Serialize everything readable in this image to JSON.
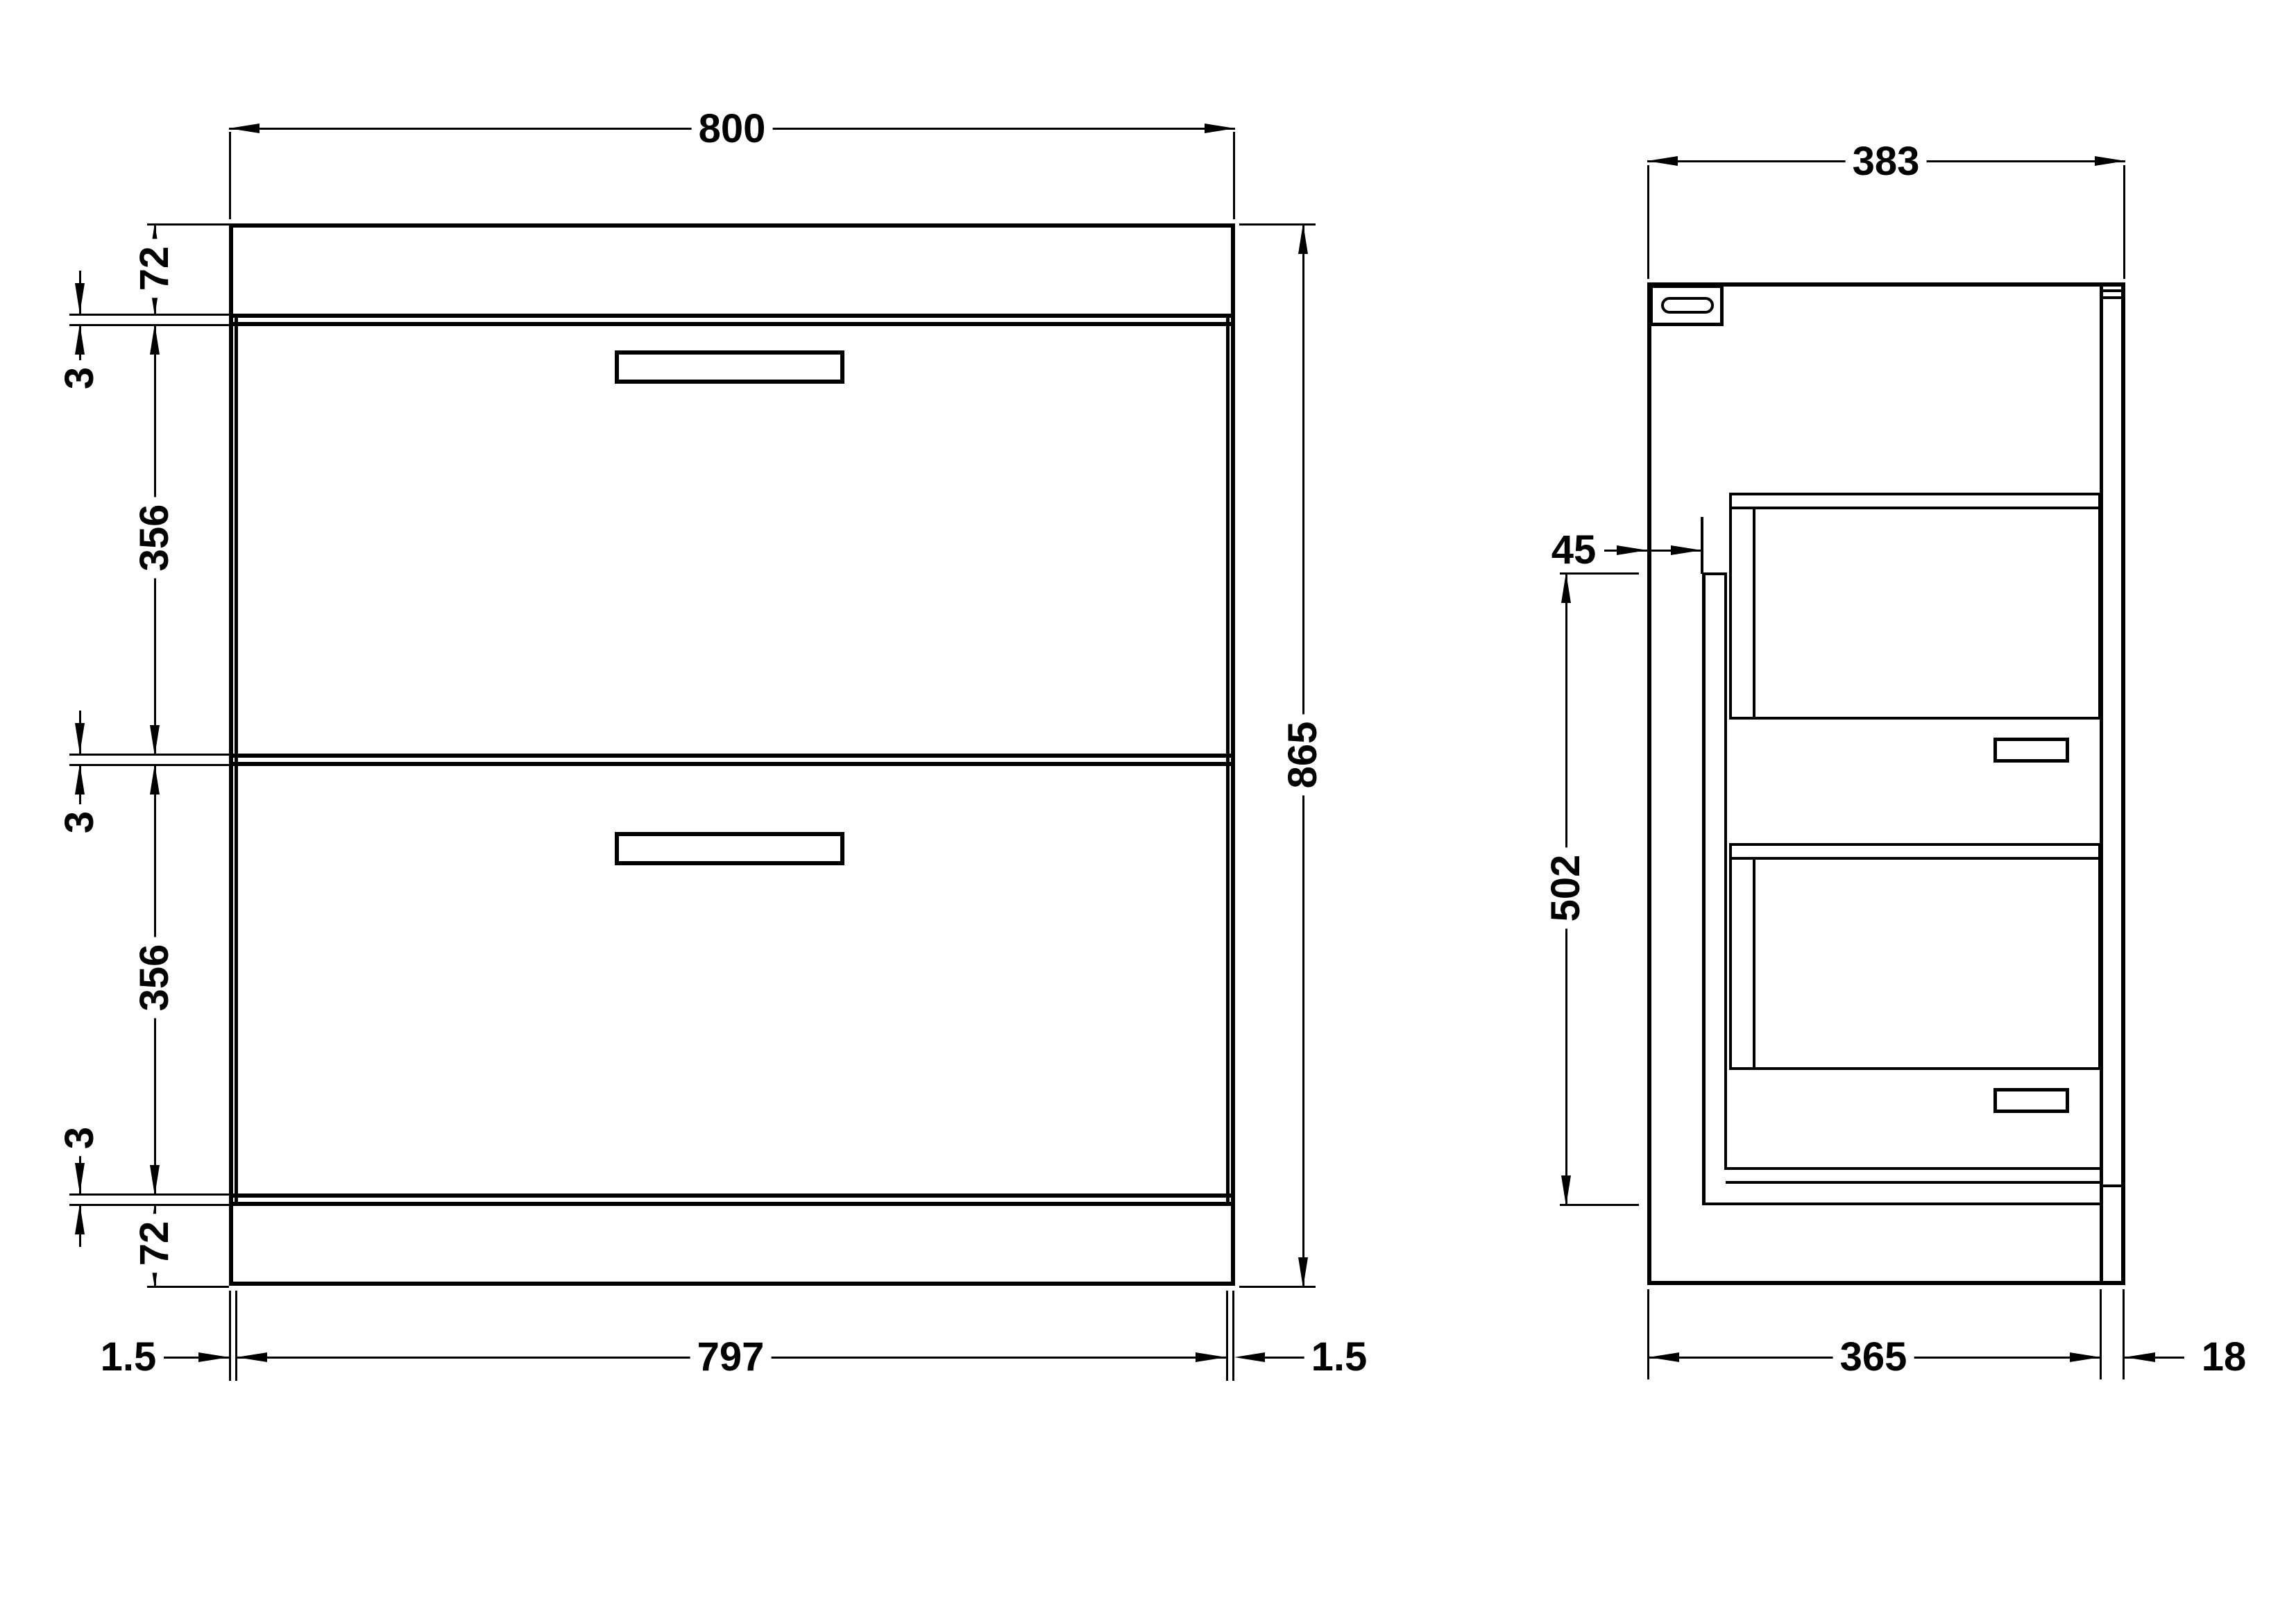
{
  "drawing": {
    "colors": {
      "line": "#000000",
      "background": "#ffffff"
    },
    "front_view": {
      "overall_width": "800",
      "overall_height": "865",
      "top_panel_height": "72",
      "plinth_height": "72",
      "gap_dims": [
        "3",
        "3",
        "3"
      ],
      "drawer_heights": [
        "356",
        "356"
      ],
      "bottom": {
        "left_reveal": "1.5",
        "drawer_width": "797",
        "right_reveal": "1.5"
      }
    },
    "side_view": {
      "overall_depth": "383",
      "back_clearance": "45",
      "back_panel_height": "502",
      "bottom": {
        "cabinet_depth": "365",
        "front_panel_thickness": "18"
      }
    }
  }
}
